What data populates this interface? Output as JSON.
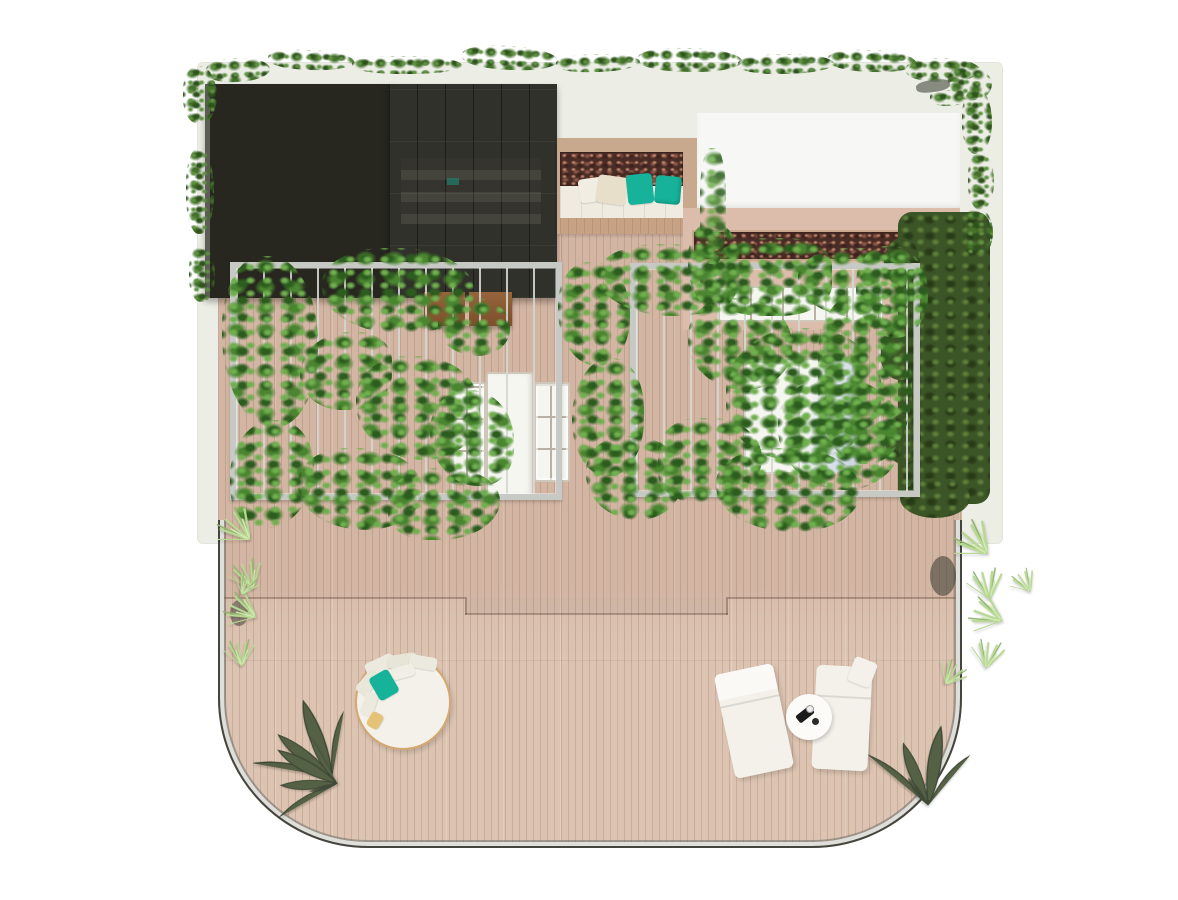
{
  "scene": {
    "description": "top-down architectural rendering of a rooftop penthouse terrace",
    "objects": [
      "dark-glass-roof",
      "glass-skylight-roof",
      "outdoor-sofa-nook",
      "teal-cushions",
      "dried-flower-planter",
      "white-roof",
      "green-hedge",
      "pergola-with-vines",
      "wood-deck",
      "deck-step",
      "deck-skylights",
      "garden-bench",
      "round-daybed",
      "sun-loungers",
      "side-table",
      "palm-trees",
      "yucca-plants",
      "glass-balustrade",
      "ivy-edge"
    ]
  },
  "colors": {
    "background": "#ffffff",
    "shell": "#eceee6",
    "roof_dark": "#27271f",
    "roof_dark_edge": "#5d5d55",
    "roof_glass": "#31312b",
    "wood_frame": "#c9a98d",
    "planter_soil": "#4a2c26",
    "planter_red": "#8a5547",
    "planter_red_dark": "#3c221d",
    "planter_red_light": "#bb8268",
    "sofa_cushion": "#efebe1",
    "pillow_teal": "#16b29a",
    "pillow_beige": "#e7dfc9",
    "roof_white": "#f7f8f5",
    "wall_pink": "#dcbcab",
    "deck_top": "#d9bdac",
    "deck_bottom": "#ddc4b2",
    "plank_line": "rgba(124,92,72,0.22)",
    "pergola_frame": "#c7cac4",
    "pergola_slat": "rgba(212,215,209,0.9)",
    "skylight_white": "#f6f6f1",
    "skylight_blue": "#c7d2e4",
    "muntin": "#b9b1a3",
    "muntin_border": "#cfc8ba",
    "bench_brown_1": "#7c4e2b",
    "bench_brown_2": "#96653c",
    "hedge_base": "#3c5526",
    "hedge_dark": "#273b17",
    "hedge_light": "#5d7f3a",
    "vine_dark": "#2c5d1e",
    "vine_mid": "#4a8630",
    "vine_light": "#6faf4e",
    "ivy_dark": "#2e531d",
    "ivy_mid": "#44722a",
    "ivy_light": "#5d9140",
    "palm_olive": "#5f7046",
    "palm_dark": "#46543a",
    "plant_light": "#b7d893",
    "plant_lighter": "#d3eab4",
    "plant_accent": "#8fb66b",
    "furniture_white": "#f3f1ea",
    "daybed_rim": "#d3a96f",
    "towel_gold": "#e5c276",
    "table_item_dark": "#1b1b1b",
    "railing_dark": "#45453f",
    "railing_light": "#dededa",
    "railing_mid": "rgba(110,110,104,0.55)"
  }
}
